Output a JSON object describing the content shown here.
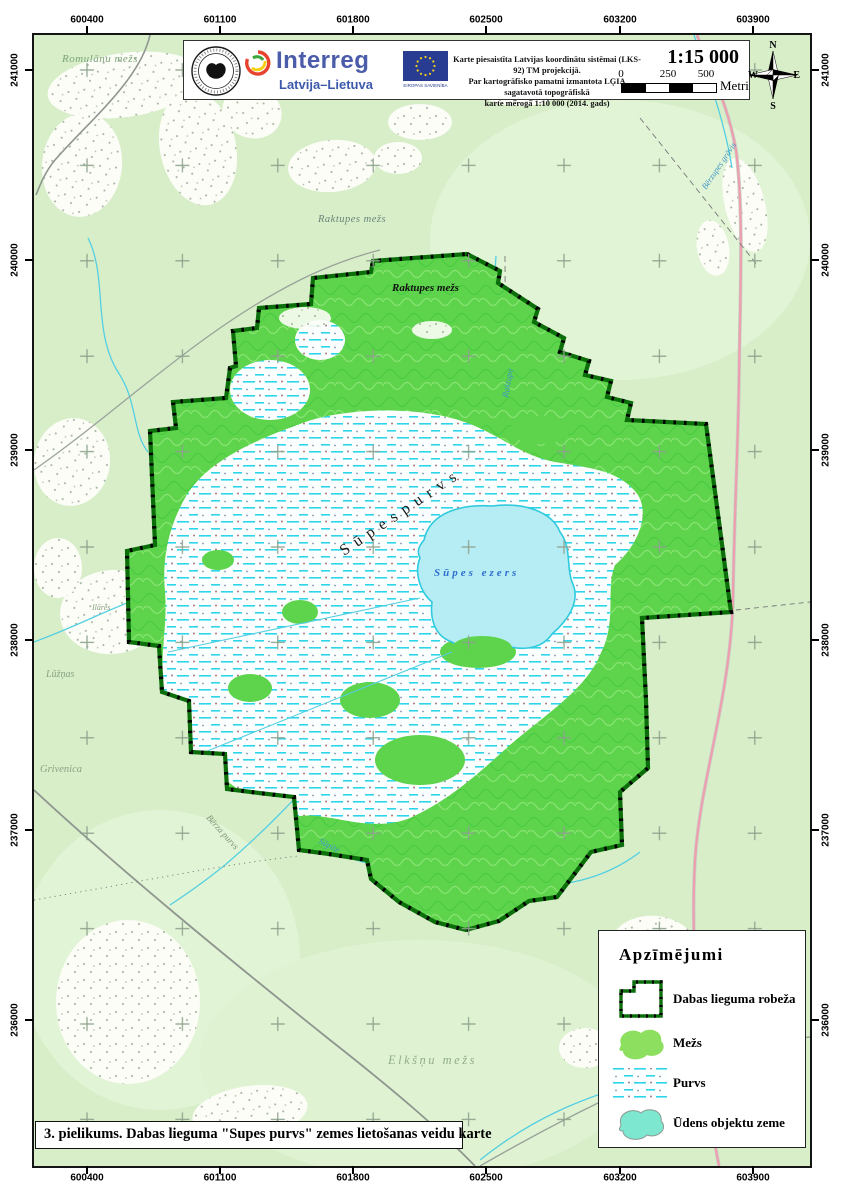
{
  "header": {
    "program": "Interreg",
    "program_sub": "Latvija–Lietuva",
    "eu_label": "EIROPAS SAVIENĪBA",
    "note_line1": "Karte piesaistīta Latvijas koordinātu sistēmai (LKS-92) TM projekcijā.",
    "note_line2": "Par kartogrāfisko pamatni izmantota LĢIA sagatavotā topogrāfiskā",
    "note_line3": "karte mērogā 1:10 000 (2014. gads)",
    "scale_ratio": "1:15 000",
    "scalebar": {
      "t0": "0",
      "t1": "250",
      "t2": "500",
      "unit": "Metri"
    },
    "compass": {
      "n": "N",
      "e": "E",
      "s": "S",
      "w": "W"
    }
  },
  "grid": {
    "x": [
      "600400",
      "601100",
      "601800",
      "602500",
      "603200",
      "603900"
    ],
    "y": [
      "241000",
      "240000",
      "239000",
      "238000",
      "237000",
      "236000"
    ]
  },
  "map_labels": {
    "romulanu": "Romulānu mežs",
    "raktupes_out": "Raktupes mežs",
    "raktupes_in": "Raktupes mežs",
    "raktupe": "Raktupe",
    "gravis": "Bērzupes grāvis",
    "supes_purvs": "S ū p e s   p u r v s",
    "supes_ezers": "Sūpes ezers",
    "ilares": "Ilāres",
    "luznas": "Lūžņas",
    "grivenica": "Grivenica",
    "berza_purvs": "Bērza purvs",
    "supite": "Sūpīte",
    "elksnu": "Elkšņu mežs"
  },
  "legend": {
    "title": "Apzīmējumi",
    "items": [
      {
        "label": "Dabas lieguma robeža"
      },
      {
        "label": "Mežs"
      },
      {
        "label": "Purvs"
      },
      {
        "label": "Ūdens objektu zeme"
      }
    ]
  },
  "footer": {
    "title": "3. pielikums. Dabas lieguma \"Supes purvs\" zemes lietošanas veidu karte"
  },
  "colors": {
    "map_background": "#d7eec9",
    "forest_green": "#5ed34c",
    "legend_forest": "#8de05f",
    "bog_dash_cyan": "#2ed5e8",
    "lake_fill": "#b6edf4",
    "lake_stroke": "#30cade",
    "reserve_boundary_green": "#0b6e0b",
    "water_label_blue": "#2f6fd0",
    "interreg_blue": "#4a5caa",
    "eu_flag_blue": "#283d92"
  }
}
